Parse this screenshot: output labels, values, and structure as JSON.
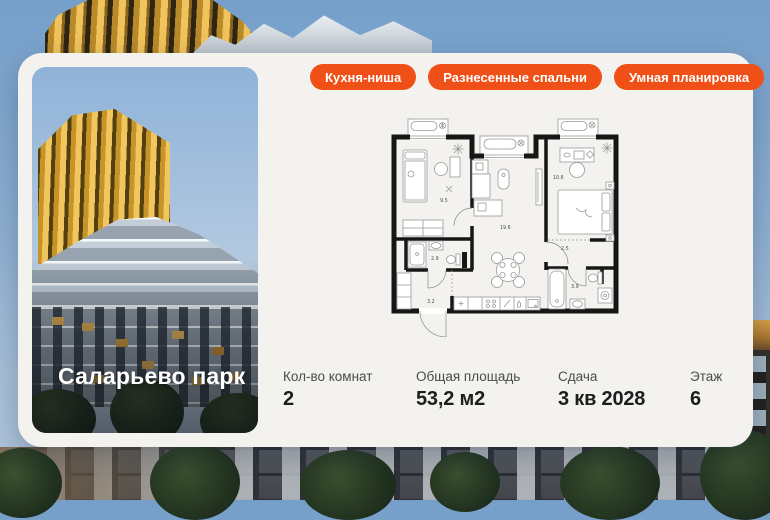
{
  "project": {
    "name": "Саларьево парк"
  },
  "badges": [
    {
      "label": "Кухня-ниша"
    },
    {
      "label": "Разнесенные спальни"
    },
    {
      "label": "Умная планировка"
    }
  ],
  "floorplan": {
    "type": "2-room apartment plan",
    "rooms": {
      "bedroom_left": "9.5",
      "living_kitchen": "19.6",
      "bedroom_right": "10.6",
      "bathroom_small": "2.9",
      "hallway": "3.2",
      "hall_pass": "2.5",
      "bathroom_large": "3.9"
    }
  },
  "stats": [
    {
      "label": "Кол-во комнат",
      "value": "2"
    },
    {
      "label": "Общая площадь",
      "value": "53,2 м2"
    },
    {
      "label": "Сдача",
      "value": "3 кв 2028"
    },
    {
      "label": "Этаж",
      "value": "6"
    }
  ],
  "colors": {
    "accent": "#EF5017",
    "card_bg": "#F3F2EF"
  }
}
